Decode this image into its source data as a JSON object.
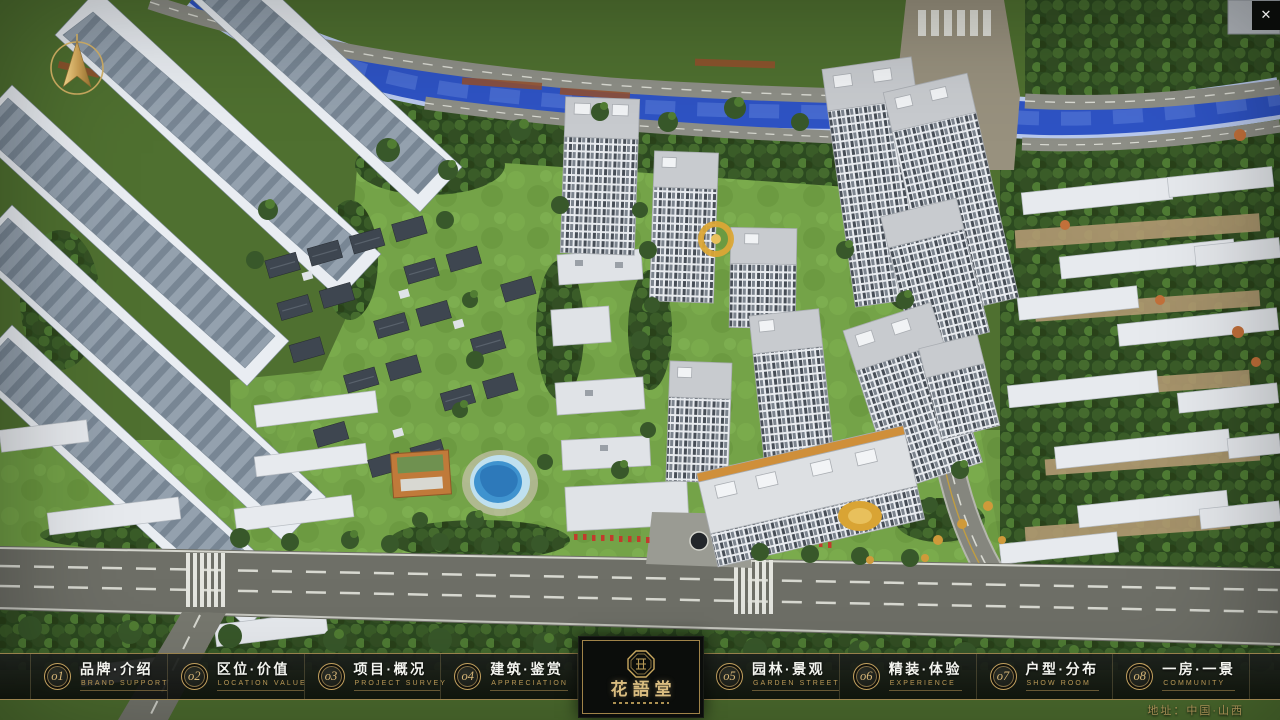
{
  "header": {
    "close_glyph": "✕"
  },
  "logo": {
    "title": "花語堂"
  },
  "menu": {
    "items": [
      {
        "num": "o1",
        "zh": "品牌·介绍",
        "en": "BRAND SUPPORT"
      },
      {
        "num": "o2",
        "zh": "区位·价值",
        "en": "LOCATION VALUE"
      },
      {
        "num": "o3",
        "zh": "项目·概况",
        "en": "PROJECT SURVEY"
      },
      {
        "num": "o4",
        "zh": "建筑·鉴赏",
        "en": "APPRECIATION"
      },
      {
        "num": "o5",
        "zh": "园林·景观",
        "en": "GARDEN STREET"
      },
      {
        "num": "o6",
        "zh": "精装·体验",
        "en": "EXPERIENCE"
      },
      {
        "num": "o7",
        "zh": "户型·分布",
        "en": "SHOW ROOM"
      },
      {
        "num": "o8",
        "zh": "一房·一景",
        "en": "COMMUNITY"
      }
    ]
  },
  "footer": {
    "address": "地址：中国·山西"
  },
  "colors": {
    "accent_gold": "#c9a85f",
    "menu_bar_background": "rgba(12,14,12,0.88)",
    "river_blue": "#2e53c4",
    "foliage_green": "#2c4a20",
    "road_gray": "#6e6f67",
    "tower_white": "#e8ebef"
  }
}
